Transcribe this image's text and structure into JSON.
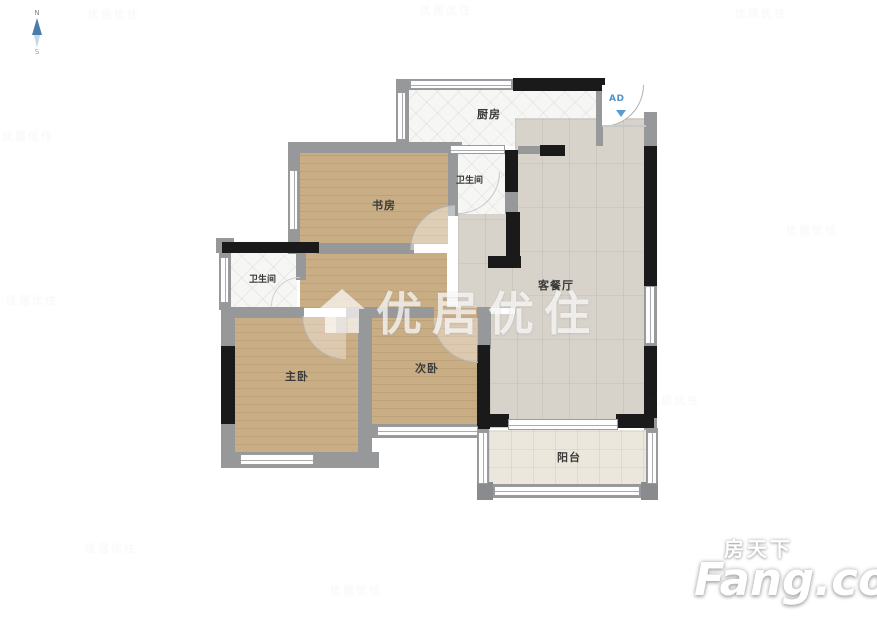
{
  "compass": {
    "north_label": "N",
    "south_label": "S"
  },
  "rooms": {
    "kitchen": "厨房",
    "bathroom_top": "卫生间",
    "study": "书房",
    "living_dining": "客餐厅",
    "bathroom_left": "卫生间",
    "master_bedroom": "主卧",
    "second_bedroom": "次卧",
    "balcony": "阳台"
  },
  "annotations": {
    "entry_marker": "AD"
  },
  "watermarks": {
    "center_text": "优居优住",
    "tile_text": "优居优住",
    "brand_cn": "房天下",
    "brand_en": "Fang.com"
  },
  "colors": {
    "wall_gray": "#97989a",
    "wall_black": "#1a1a1a",
    "wood_floor": "#c9ad85",
    "living_floor": "#d8d3ca",
    "balcony_floor": "#ece7dc",
    "tile_floor": "#f6f6f5",
    "accent_blue": "#4f93c8"
  }
}
